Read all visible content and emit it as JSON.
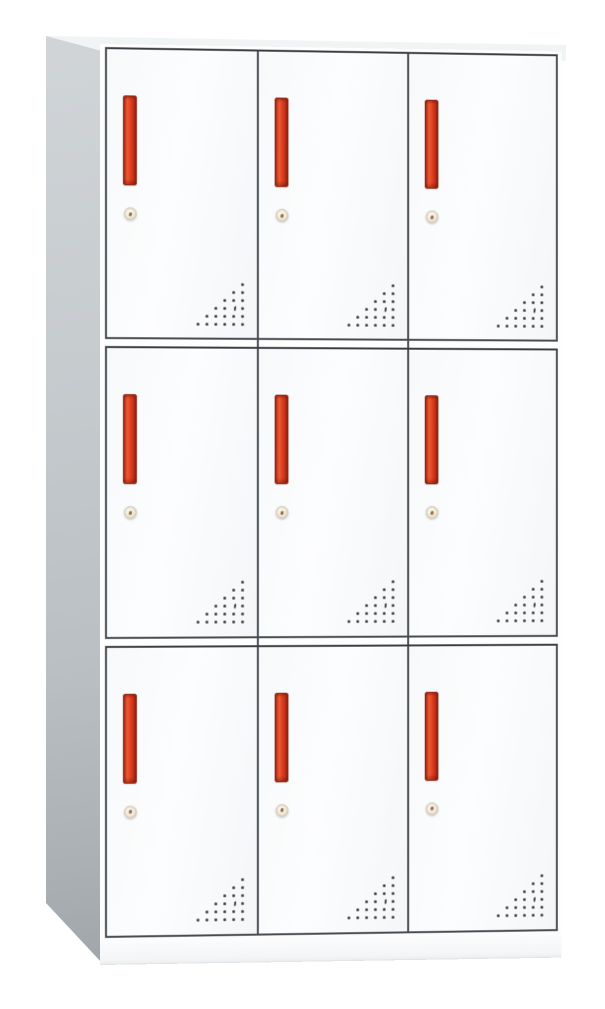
{
  "page": {
    "background_color": "#ffffff",
    "subject": "nine-door metal storage locker cabinet, front three-quarter product view"
  },
  "cabinet": {
    "rows": 3,
    "columns": 3,
    "door_count": 9,
    "features_per_door": [
      "handle-icon",
      "keyhole-icon",
      "vent-holes-icon"
    ],
    "vent_pattern": {
      "rows": 6,
      "style": "right-aligned-triangle",
      "crescent_row_index": 3,
      "crescent_from_right": 2
    },
    "colors": {
      "background": "#ffffff",
      "door_face": "#f9fbfc",
      "door_outline": "#474c51",
      "handle_red": "#df3f1f",
      "handle_highlight": "#ee5a30",
      "handle_border": "#8f2414",
      "lock_face": "#f1e7d4",
      "lock_ring": "#cfc5b2",
      "vent_dot": "#3b4044",
      "side_panel_light": "#d2d6d9",
      "side_panel_dark": "#989ea2",
      "top_surface": "#f5f8f9",
      "base_plinth": "#f3f5f6"
    }
  }
}
